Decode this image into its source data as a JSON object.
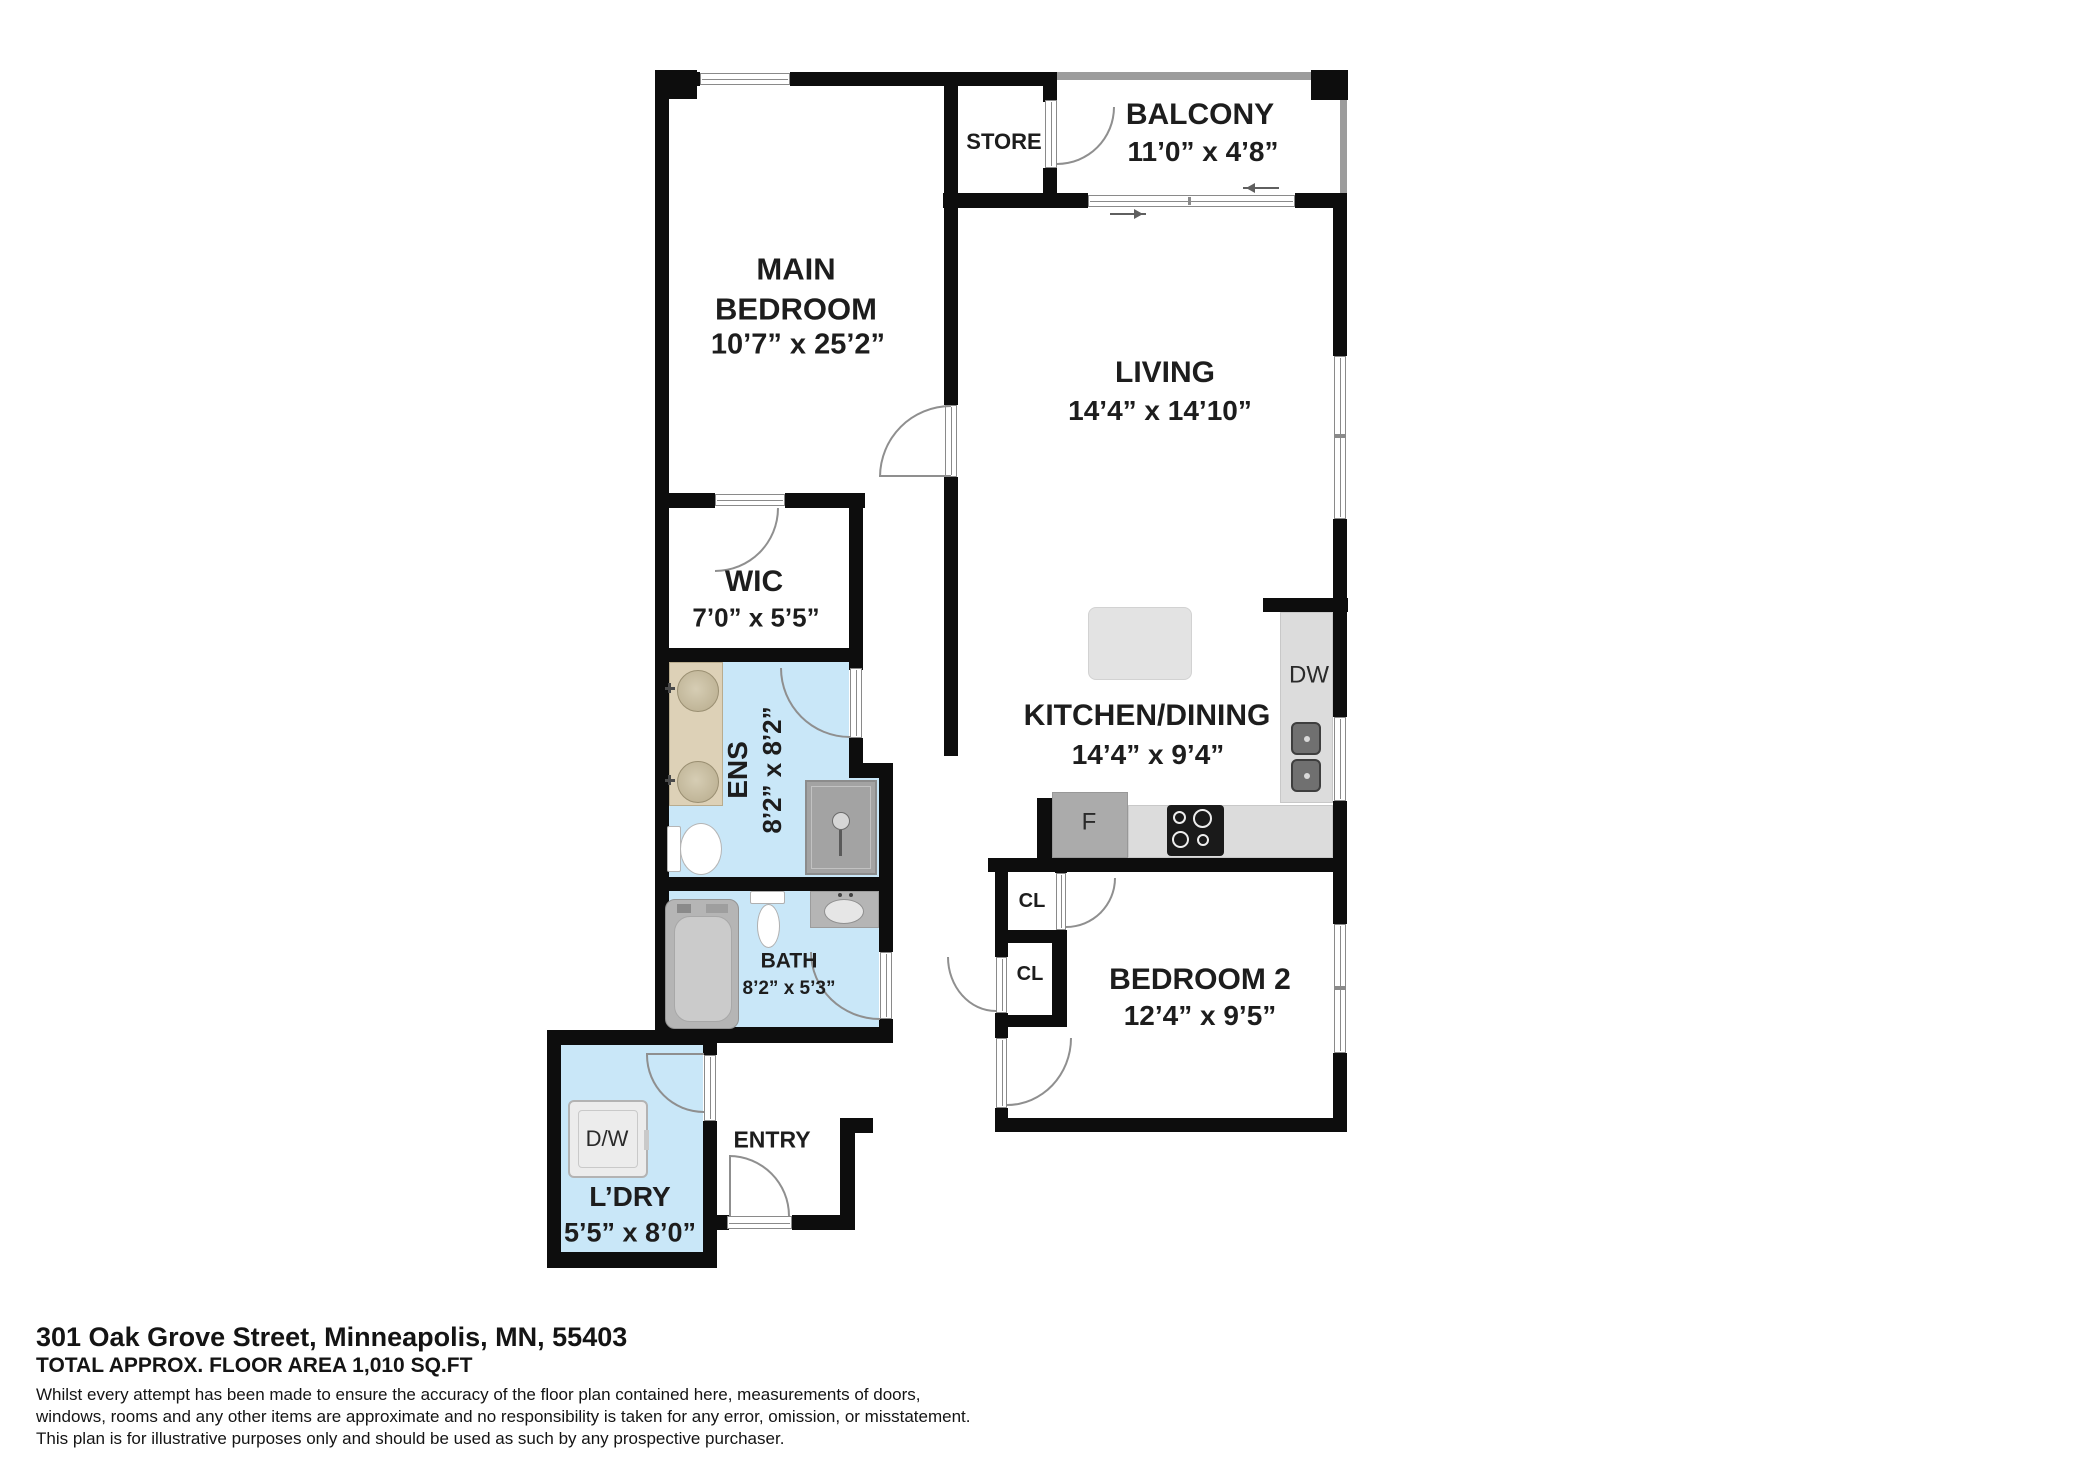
{
  "plan": {
    "rooms": {
      "main_bedroom": {
        "name": "MAIN BEDROOM",
        "dims": "10’7” x 25’2”"
      },
      "store": {
        "name": "STORE"
      },
      "balcony": {
        "name": "BALCONY",
        "dims": "11’0” x 4’8”"
      },
      "living": {
        "name": "LIVING",
        "dims": "14’4” x 14’10”"
      },
      "wic": {
        "name": "WIC",
        "dims": "7’0” x 5’5”"
      },
      "ens": {
        "name": "ENS",
        "dims": "8’2” x 8’2”"
      },
      "kitchen": {
        "name": "KITCHEN/DINING",
        "dims": "14’4” x 9’4”"
      },
      "bath": {
        "name": "BATH",
        "dims": "8’2” x 5’3”"
      },
      "bedroom2": {
        "name": "BEDROOM 2",
        "dims": "12’4” x 9’5”"
      },
      "entry": {
        "name": "ENTRY"
      },
      "laundry": {
        "name": "L’DRY",
        "dims": "5’5” x 8’0”"
      },
      "closet1": {
        "name": "CL"
      },
      "closet2": {
        "name": "CL"
      }
    },
    "appliances": {
      "dishwasher": "DW",
      "fridge": "F",
      "washer_dryer": "D/W"
    },
    "colors": {
      "wall": "#0d0d0d",
      "wet_room": "#c9e7f8",
      "counter": "#dcdcdc",
      "appliance": "#ababab"
    }
  },
  "footer": {
    "address": "301 Oak Grove Street, Minneapolis, MN, 55403",
    "area": "TOTAL APPROX. FLOOR AREA 1,010 SQ.FT",
    "disclaimer1": "Whilst every attempt has been made to ensure the accuracy of the floor plan contained here, measurements of doors,",
    "disclaimer2": "windows, rooms and any other items are approximate and no responsibility is taken for any error, omission, or misstatement.",
    "disclaimer3": "This plan is for illustrative purposes only and should be used as such by any prospective purchaser."
  }
}
